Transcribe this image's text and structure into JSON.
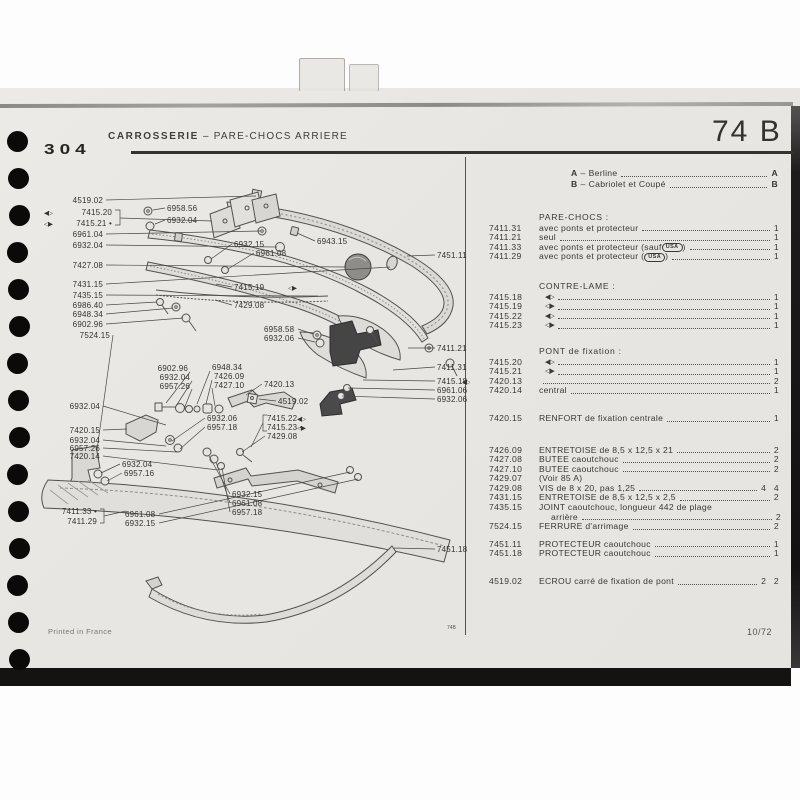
{
  "colors": {
    "paper": "#e9e7e3",
    "ink_dark": "#34312e",
    "ink_text": "#3a3834",
    "line": "#4a4a4a"
  },
  "header": {
    "model": "304",
    "title": "CARROSSERIE",
    "dash": "–",
    "subtitle": "PARE-CHOCS  ARRIERE",
    "page_code": "74 B"
  },
  "footer": {
    "left": "Printed in France",
    "divider_code": "74B",
    "right": "10/72"
  },
  "legend": {
    "dash": "–",
    "items": [
      {
        "key": "A",
        "label": "Berline",
        "ref": "A"
      },
      {
        "key": "B",
        "label": "Cabriolet et Coupé",
        "ref": "B"
      }
    ]
  },
  "icon_glyphs": {
    "side-left": "◀▷",
    "side-right": "◁▶"
  },
  "parts_list": {
    "sections": [
      {
        "title": "PARE-CHOCS :",
        "rows": [
          {
            "ref": "7411.31",
            "desc": "avec ponts et protecteur",
            "qty": "1"
          },
          {
            "ref": "7411.21",
            "desc": "seul",
            "qty": "1"
          },
          {
            "ref": "7411.33",
            "desc": "avec ponts et protecteur (sauf ",
            "badge": "USA",
            "after_badge": ")",
            "qty": "1"
          },
          {
            "ref": "7411.29",
            "desc": "avec ponts et protecteur (",
            "badge": "USA",
            "after_badge": ")",
            "qty": "1"
          }
        ]
      },
      {
        "title": "CONTRE-LAME :",
        "rows": [
          {
            "ref": "7415.18",
            "icon": "side-left",
            "qty": "1"
          },
          {
            "ref": "7415.19",
            "icon": "side-right",
            "qty": "1"
          },
          {
            "ref": "7415.22",
            "icon": "side-left",
            "qty": "1"
          },
          {
            "ref": "7415.23",
            "icon": "side-right",
            "qty": "1"
          }
        ]
      },
      {
        "title": "PONT de fixation :",
        "rows": [
          {
            "ref": "7415.20",
            "icon": "side-left",
            "qty": "1"
          },
          {
            "ref": "7415.21",
            "icon": "side-right",
            "qty": "1"
          },
          {
            "ref": "7420.13",
            "desc": "",
            "qty": "2"
          },
          {
            "ref": "7420.14",
            "desc": "central",
            "qty": "1"
          }
        ]
      },
      {
        "title": "",
        "rows": [
          {
            "ref": "7420.15",
            "desc": "RENFORT de fixation centrale",
            "qty": "1"
          }
        ]
      },
      {
        "title": "",
        "rows": [
          {
            "ref": "7426.09",
            "desc": "ENTRETOISE de 8,5 x 12,5 x 21",
            "qty": "2"
          },
          {
            "ref": "7427.08",
            "desc": "BUTEE caoutchouc",
            "qty": "2"
          },
          {
            "ref": "7427.10",
            "desc": "BUTEE caoutchouc",
            "qty": "2"
          },
          {
            "ref": "7429.07",
            "desc": "(Voir 85 A)",
            "qty": "",
            "no_leader": true
          },
          {
            "ref": "7429.08",
            "desc": "VIS de 8 x 20, pas 1,25",
            "qty": "4 4"
          },
          {
            "ref": "7431.15",
            "desc": "ENTRETOISE de 8,5 x 12,5 x 2,5",
            "qty": "2"
          },
          {
            "ref": "7435.15",
            "desc": "JOINT caoutchouc, longueur 442 de plage",
            "desc2": "arrière",
            "qty": "2"
          },
          {
            "ref": "7524.15",
            "desc": "FERRURE d'arrimage",
            "qty": "2"
          }
        ]
      },
      {
        "title": "",
        "rows": [
          {
            "ref": "7451.11",
            "desc": "PROTECTEUR caoutchouc",
            "qty": "1"
          },
          {
            "ref": "7451.18",
            "desc": "PROTECTEUR caoutchouc",
            "qty": "1"
          }
        ]
      },
      {
        "title": "",
        "rows": [
          {
            "ref": "4519.02",
            "desc": "ECROU carré de fixation de pont",
            "qty": "2 2"
          }
        ]
      }
    ]
  },
  "diagram": {
    "labels": [
      {
        "text": "4519.02",
        "x": 103,
        "y": 203,
        "anchor": "end",
        "line": [
          [
            106,
            200
          ],
          [
            256,
            196
          ]
        ]
      },
      {
        "text": "7415.20",
        "x": 112,
        "y": 215,
        "anchor": "end"
      },
      {
        "text": "7415.21",
        "x": 112,
        "y": 226,
        "anchor": "end",
        "dot": true
      },
      {
        "text": "6961.04",
        "x": 103,
        "y": 237,
        "anchor": "end",
        "line": [
          [
            106,
            234
          ],
          [
            260,
            231
          ]
        ]
      },
      {
        "text": "6932.04",
        "x": 103,
        "y": 248,
        "anchor": "end",
        "line": [
          [
            106,
            245
          ],
          [
            277,
            247
          ]
        ]
      },
      {
        "text": "7427.08",
        "x": 103,
        "y": 268,
        "anchor": "end",
        "line": [
          [
            106,
            265
          ],
          [
            346,
            267
          ]
        ]
      },
      {
        "text": "7431.15",
        "x": 103,
        "y": 287,
        "anchor": "end",
        "line": [
          [
            106,
            284
          ],
          [
            390,
            267
          ]
        ]
      },
      {
        "text": "7435.15",
        "x": 103,
        "y": 298,
        "anchor": "end",
        "line": [
          [
            106,
            295
          ],
          [
            318,
            296
          ]
        ]
      },
      {
        "text": "6986.40",
        "x": 103,
        "y": 308,
        "anchor": "end",
        "line": [
          [
            106,
            305
          ],
          [
            157,
            302
          ]
        ]
      },
      {
        "text": "6948.34",
        "x": 103,
        "y": 317,
        "anchor": "end",
        "line": [
          [
            106,
            314
          ],
          [
            173,
            308
          ]
        ]
      },
      {
        "text": "6902.96",
        "x": 103,
        "y": 327,
        "anchor": "end",
        "line": [
          [
            106,
            324
          ],
          [
            183,
            318
          ]
        ]
      },
      {
        "text": "7524.15",
        "x": 110,
        "y": 338,
        "anchor": "end",
        "line": [
          [
            113,
            335
          ],
          [
            97,
            450
          ]
        ]
      },
      {
        "text": "6932.04",
        "x": 100,
        "y": 409,
        "anchor": "end",
        "line": [
          [
            103,
            406
          ],
          [
            166,
            425
          ]
        ]
      },
      {
        "text": "7420.15",
        "x": 100,
        "y": 433,
        "anchor": "end",
        "line": [
          [
            103,
            430
          ],
          [
            127,
            429
          ]
        ]
      },
      {
        "text": "6932.04",
        "x": 100,
        "y": 443,
        "anchor": "end",
        "line": [
          [
            103,
            440
          ],
          [
            166,
            446
          ]
        ]
      },
      {
        "text": "6957.26",
        "x": 100,
        "y": 451,
        "anchor": "end",
        "line": [
          [
            103,
            448
          ],
          [
            177,
            452
          ]
        ]
      },
      {
        "text": "7420.14",
        "x": 100,
        "y": 459,
        "anchor": "end",
        "line": [
          [
            103,
            456
          ],
          [
            218,
            470
          ]
        ]
      },
      {
        "text": "6932.04",
        "x": 122,
        "y": 467,
        "anchor": "start",
        "line": [
          [
            120,
            464
          ],
          [
            101,
            473
          ]
        ]
      },
      {
        "text": "6957.16",
        "x": 124,
        "y": 476,
        "anchor": "start",
        "line": [
          [
            122,
            473
          ],
          [
            107,
            481
          ]
        ]
      },
      {
        "text": "7411.33",
        "x": 97,
        "y": 514,
        "anchor": "end",
        "dot": true
      },
      {
        "text": "7411.29",
        "x": 97,
        "y": 524,
        "anchor": "end"
      },
      {
        "text": "6961.08",
        "x": 125,
        "y": 517,
        "anchor": "start",
        "line": [
          [
            159,
            514
          ],
          [
            350,
            472
          ]
        ]
      },
      {
        "text": "6932.15",
        "x": 125,
        "y": 526,
        "anchor": "start",
        "line": [
          [
            159,
            523
          ],
          [
            358,
            479
          ]
        ]
      },
      {
        "text": "6932.06",
        "x": 207,
        "y": 421,
        "anchor": "start",
        "line": [
          [
            205,
            418
          ],
          [
            172,
            441
          ]
        ]
      },
      {
        "text": "6957.18",
        "x": 207,
        "y": 430,
        "anchor": "start",
        "line": [
          [
            205,
            427
          ],
          [
            180,
            449
          ]
        ]
      },
      {
        "text": "6902.96",
        "x": 188,
        "y": 371,
        "anchor": "end",
        "line": [
          [
            190,
            372
          ],
          [
            166,
            403
          ]
        ]
      },
      {
        "text": "6932.04",
        "x": 190,
        "y": 380,
        "anchor": "end",
        "line": [
          [
            192,
            381
          ],
          [
            176,
            406
          ]
        ]
      },
      {
        "text": "6957.26",
        "x": 190,
        "y": 389,
        "anchor": "end",
        "line": [
          [
            192,
            389
          ],
          [
            184,
            409
          ]
        ]
      },
      {
        "text": "6948.34",
        "x": 212,
        "y": 370,
        "anchor": "start",
        "line": [
          [
            210,
            371
          ],
          [
            197,
            404
          ]
        ]
      },
      {
        "text": "7426.09",
        "x": 214,
        "y": 379,
        "anchor": "start",
        "line": [
          [
            212,
            380
          ],
          [
            206,
            404
          ]
        ]
      },
      {
        "text": "7427.10",
        "x": 214,
        "y": 388,
        "anchor": "start",
        "line": [
          [
            212,
            388
          ],
          [
            215,
            406
          ]
        ]
      },
      {
        "text": "7420.13",
        "x": 264,
        "y": 387,
        "anchor": "start",
        "line": [
          [
            262,
            384
          ],
          [
            246,
            395
          ]
        ]
      },
      {
        "text": "4519.02",
        "x": 278,
        "y": 404,
        "anchor": "start",
        "line": [
          [
            276,
            401
          ],
          [
            259,
            399
          ]
        ]
      },
      {
        "text": "7415.22",
        "x": 267,
        "y": 421,
        "anchor": "start"
      },
      {
        "text": "7415.23",
        "x": 267,
        "y": 430,
        "anchor": "start",
        "dot": true
      },
      {
        "text": "7429.08",
        "x": 267,
        "y": 439,
        "anchor": "start",
        "line": [
          [
            265,
            436
          ],
          [
            242,
            452
          ]
        ]
      },
      {
        "text": "6932.15",
        "x": 232,
        "y": 497,
        "anchor": "start",
        "line": [
          [
            230,
            494
          ],
          [
            209,
            456
          ]
        ]
      },
      {
        "text": "6961.08",
        "x": 232,
        "y": 506,
        "anchor": "start",
        "line": [
          [
            230,
            503
          ],
          [
            216,
            462
          ]
        ]
      },
      {
        "text": "6957.18",
        "x": 232,
        "y": 515,
        "anchor": "start",
        "line": [
          [
            230,
            512
          ],
          [
            222,
            468
          ]
        ]
      },
      {
        "text": "6958.56",
        "x": 167,
        "y": 211,
        "anchor": "start",
        "line": [
          [
            165,
            208
          ],
          [
            153,
            210
          ]
        ]
      },
      {
        "text": "6932.04",
        "x": 167,
        "y": 223,
        "anchor": "start",
        "line": [
          [
            165,
            220
          ],
          [
            155,
            224
          ]
        ]
      },
      {
        "text": "6943.15",
        "x": 317,
        "y": 244,
        "anchor": "start",
        "line": [
          [
            315,
            241
          ],
          [
            297,
            233
          ]
        ]
      },
      {
        "text": "7451.11",
        "x": 437,
        "y": 258,
        "anchor": "start",
        "line": [
          [
            435,
            255
          ],
          [
            407,
            256
          ]
        ]
      },
      {
        "text": "6932.15",
        "x": 234,
        "y": 247,
        "anchor": "start",
        "line": [
          [
            232,
            244
          ],
          [
            211,
            259
          ]
        ]
      },
      {
        "text": "6961.08",
        "x": 256,
        "y": 256,
        "anchor": "start",
        "line": [
          [
            254,
            253
          ],
          [
            228,
            269
          ]
        ]
      },
      {
        "text": "7415.19",
        "x": 234,
        "y": 290,
        "anchor": "start",
        "line": [
          [
            232,
            287
          ],
          [
            216,
            284
          ]
        ]
      },
      {
        "text": "7429.08",
        "x": 234,
        "y": 308,
        "anchor": "start",
        "line": [
          [
            232,
            305
          ],
          [
            215,
            300
          ]
        ]
      },
      {
        "text": "6958.58",
        "x": 264,
        "y": 332,
        "anchor": "start",
        "line": [
          [
            298,
            329
          ],
          [
            313,
            334
          ]
        ]
      },
      {
        "text": "6932.06",
        "x": 264,
        "y": 341,
        "anchor": "start",
        "line": [
          [
            298,
            338
          ],
          [
            315,
            342
          ]
        ]
      },
      {
        "text": "7411.21",
        "x": 437,
        "y": 351,
        "anchor": "start",
        "line": [
          [
            435,
            348
          ],
          [
            408,
            348
          ]
        ]
      },
      {
        "text": "7411.31",
        "x": 437,
        "y": 370,
        "anchor": "start",
        "line": [
          [
            435,
            367
          ],
          [
            393,
            370
          ]
        ]
      },
      {
        "text": "7415.18",
        "x": 437,
        "y": 384,
        "anchor": "start",
        "line": [
          [
            435,
            381
          ],
          [
            363,
            380
          ]
        ]
      },
      {
        "text": "6961.06",
        "x": 437,
        "y": 393,
        "anchor": "start",
        "line": [
          [
            435,
            390
          ],
          [
            348,
            388
          ]
        ]
      },
      {
        "text": "6932.06",
        "x": 437,
        "y": 402,
        "anchor": "start",
        "line": [
          [
            435,
            399
          ],
          [
            342,
            396
          ]
        ]
      },
      {
        "text": "7451.18",
        "x": 437,
        "y": 552,
        "anchor": "start",
        "line": [
          [
            435,
            549
          ],
          [
            394,
            548
          ]
        ]
      }
    ],
    "icons": [
      {
        "glyph": "side-left",
        "x": 44,
        "y": 215
      },
      {
        "glyph": "side-right",
        "x": 44,
        "y": 226
      },
      {
        "glyph": "side-right",
        "x": 288,
        "y": 290
      },
      {
        "glyph": "side-left",
        "x": 297,
        "y": 421
      },
      {
        "glyph": "side-right",
        "x": 297,
        "y": 430
      },
      {
        "glyph": "side-left",
        "x": 462,
        "y": 384
      }
    ],
    "extra_lines": [
      [
        [
          115,
          210
        ],
        [
          120,
          210
        ],
        [
          120,
          225
        ],
        [
          115,
          225
        ]
      ],
      [
        [
          120,
          218
        ],
        [
          212,
          221
        ]
      ],
      [
        [
          100,
          509
        ],
        [
          104,
          509
        ],
        [
          104,
          523
        ],
        [
          100,
          523
        ]
      ],
      [
        [
          104,
          516
        ],
        [
          126,
          511
        ]
      ],
      [
        [
          267,
          415
        ],
        [
          263,
          415
        ],
        [
          263,
          431
        ],
        [
          267,
          431
        ]
      ],
      [
        [
          263,
          423
        ],
        [
          251,
          447
        ]
      ]
    ]
  }
}
